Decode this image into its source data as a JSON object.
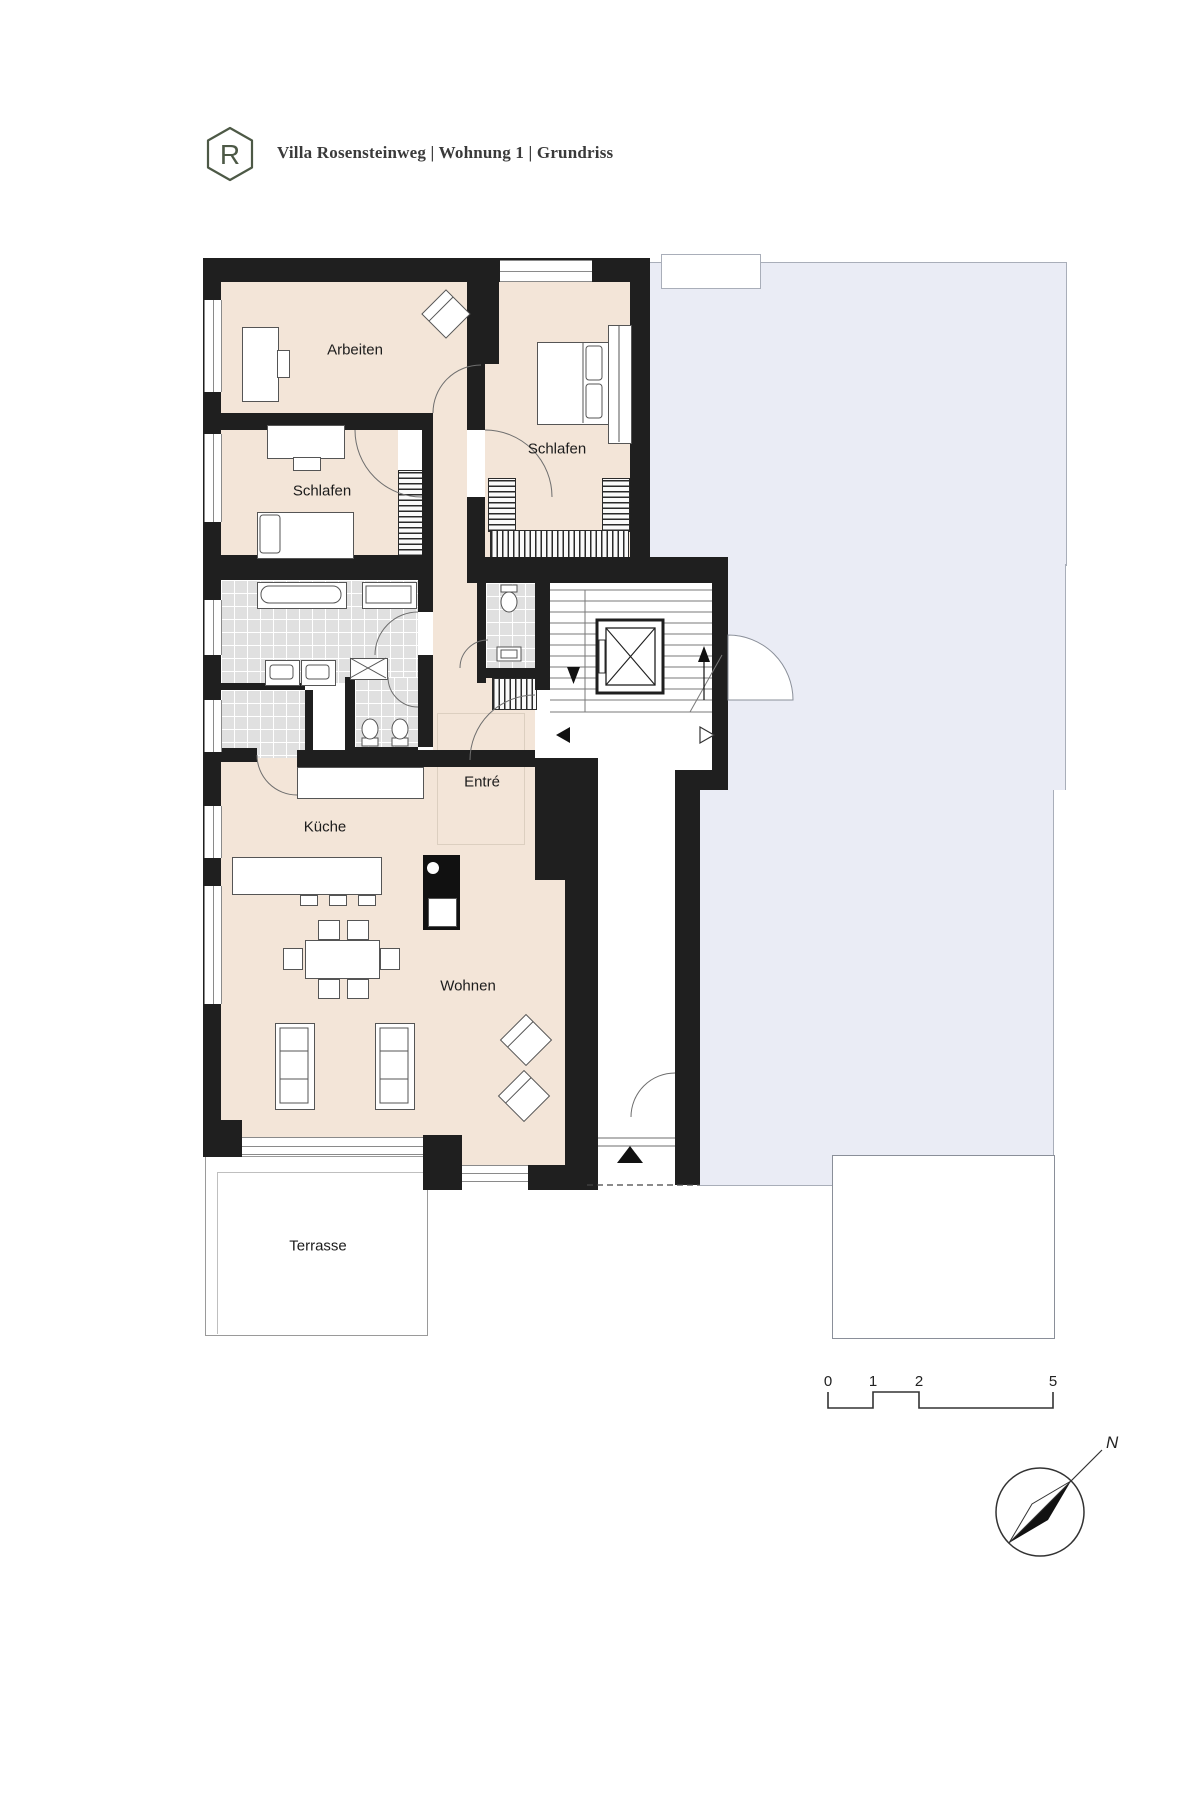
{
  "header": {
    "logo_letter": "R",
    "title": "Villa Rosensteinweg | Wohnung 1 | Grundriss"
  },
  "room_labels": {
    "arbeiten": "Arbeiten",
    "schlafen_top": "Schlafen",
    "schlafen_left": "Schlafen",
    "entree": "Entré",
    "kueche": "Küche",
    "wohnen": "Wohnen",
    "terrasse": "Terrasse"
  },
  "scale_bar": {
    "tick_0": "0",
    "tick_1": "1",
    "tick_2": "2",
    "tick_5": "5"
  },
  "compass": {
    "north": "N"
  },
  "colors": {
    "wall": "#1f1f1f",
    "room_fill": "#f3e5d8",
    "neighbor_fill": "#eaecf5",
    "tile_fill": "#e0e0e0",
    "logo_green": "#4d5946"
  }
}
